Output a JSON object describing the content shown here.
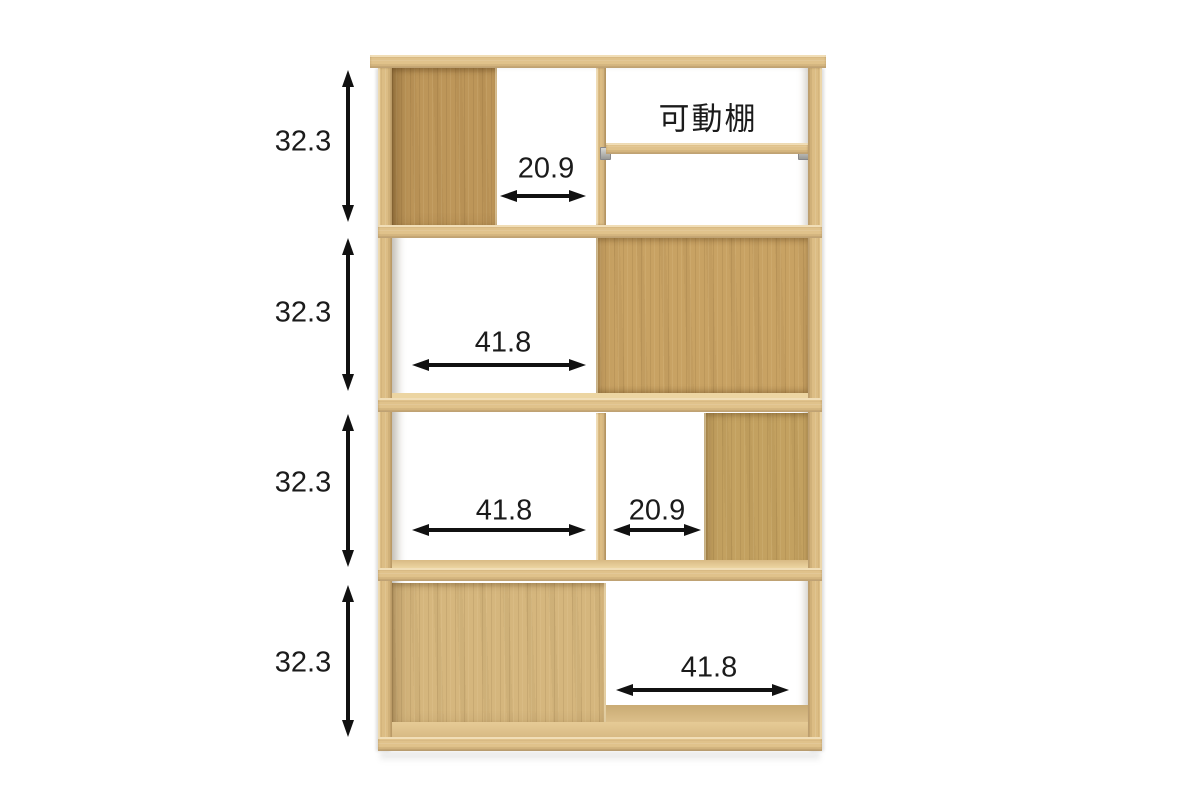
{
  "product": {
    "kind": "display-shelf-dimension-diagram",
    "tiers": 4
  },
  "colors": {
    "background": "#ffffff",
    "wood_frame": "#e0c28b",
    "wood_frame_light": "#ecd5a4",
    "wood_panel_dark": "#bd9659",
    "wood_panel": "#c8a263",
    "wood_panel_light": "#d5b77e",
    "annotation_text": "#1b1b1b",
    "arrow": "#111111",
    "shelf_pin": "#b9b9b6"
  },
  "annotations": {
    "movable_shelf_label": "可動棚",
    "vertical_dimensions": [
      {
        "value": "32.3"
      },
      {
        "value": "32.3"
      },
      {
        "value": "32.3"
      },
      {
        "value": "32.3"
      }
    ],
    "horizontal_dimensions": [
      {
        "tier": 1,
        "value": "20.9"
      },
      {
        "tier": 2,
        "value": "41.8"
      },
      {
        "tier": 3,
        "value": "41.8"
      },
      {
        "tier": 3,
        "value": "20.9"
      },
      {
        "tier": 4,
        "value": "41.8"
      }
    ]
  }
}
